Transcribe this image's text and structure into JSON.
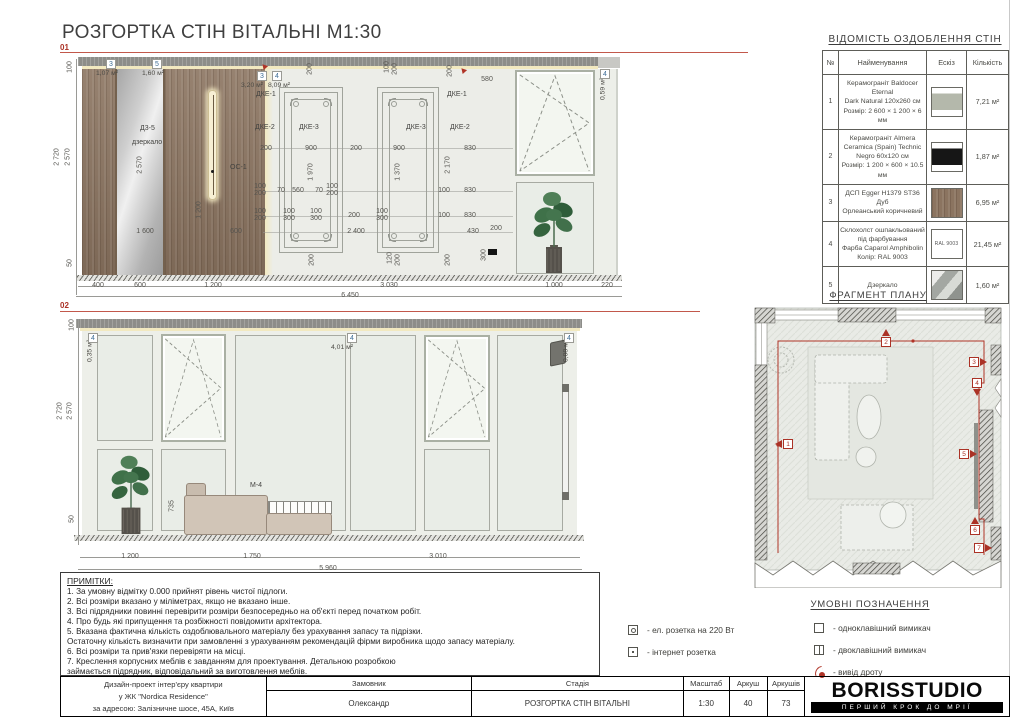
{
  "sheet": {
    "title": "РОЗГОРТКА СТІН ВІТАЛЬНІ М1:30"
  },
  "colors": {
    "accent_red": "#ab3226",
    "tag_blue": "#3e6d96",
    "wood": "#8b7460",
    "wall": "#ecede8"
  },
  "elevations": [
    {
      "label": "01",
      "dims": [
        [
          "100",
          10,
          22,
          1
        ],
        [
          "2 720",
          -3,
          112,
          1
        ],
        [
          "2 570",
          8,
          112,
          1
        ],
        [
          "50",
          10,
          218,
          1
        ],
        [
          "2 570",
          80,
          120,
          1
        ],
        [
          "1 200",
          139,
          165,
          1
        ],
        [
          "400",
          38,
          237
        ],
        [
          "600",
          80,
          237
        ],
        [
          "1 200",
          153,
          237
        ],
        [
          "3 030",
          329,
          237
        ],
        [
          "1 000",
          494,
          237
        ],
        [
          "220",
          547,
          237
        ],
        [
          "6 450",
          290,
          247
        ],
        [
          "1 600",
          85,
          183
        ],
        [
          "600",
          176,
          183
        ],
        [
          "2 400",
          296,
          183
        ],
        [
          "430",
          413,
          183
        ],
        [
          "200",
          436,
          180
        ],
        [
          "200",
          250,
          24,
          1
        ],
        [
          "100",
          327,
          22,
          1
        ],
        [
          "200",
          335,
          24,
          1
        ],
        [
          "200",
          390,
          26,
          1
        ],
        [
          "580",
          427,
          31
        ],
        [
          "200",
          206,
          100
        ],
        [
          "900",
          251,
          100
        ],
        [
          "200",
          296,
          100
        ],
        [
          "900",
          339,
          100
        ],
        [
          "830",
          410,
          100
        ],
        [
          "1 970",
          251,
          127,
          1
        ],
        [
          "1 370",
          338,
          127,
          1
        ],
        [
          "2 170",
          388,
          120,
          1
        ],
        [
          "100",
          200,
          138
        ],
        [
          "200",
          200,
          145
        ],
        [
          "70",
          221,
          142
        ],
        [
          "560",
          238,
          142
        ],
        [
          "70",
          259,
          142
        ],
        [
          "100",
          272,
          138
        ],
        [
          "200",
          272,
          145
        ],
        [
          "100",
          384,
          142
        ],
        [
          "830",
          410,
          142
        ],
        [
          "100",
          200,
          163
        ],
        [
          "200",
          200,
          170
        ],
        [
          "100",
          229,
          163
        ],
        [
          "300",
          229,
          170
        ],
        [
          "100",
          256,
          163
        ],
        [
          "300",
          256,
          170
        ],
        [
          "200",
          294,
          167
        ],
        [
          "100",
          322,
          163
        ],
        [
          "300",
          322,
          170
        ],
        [
          "100",
          384,
          167
        ],
        [
          "830",
          410,
          167
        ],
        [
          "200",
          252,
          215,
          1
        ],
        [
          "120",
          330,
          213,
          1
        ],
        [
          "200",
          338,
          215,
          1
        ],
        [
          "200",
          388,
          215,
          1
        ],
        [
          "300",
          424,
          210,
          1
        ]
      ],
      "tags": [
        [
          "3",
          "1,07 м²",
          46,
          14,
          36,
          25,
          0
        ],
        [
          "5",
          "1,60 м²",
          92,
          14,
          82,
          25,
          0
        ],
        [
          "3",
          "3,20 м²",
          197,
          26,
          181,
          37,
          0
        ],
        [
          "4",
          "8,09 м²",
          212,
          26,
          208,
          37,
          0
        ],
        [
          "4",
          "0,59 м²",
          540,
          24,
          543,
          44,
          1
        ]
      ],
      "labels": [
        [
          "Д3-5",
          80,
          80
        ],
        [
          "дзеркало",
          72,
          94
        ],
        [
          "ОС-1",
          170,
          119
        ],
        [
          "ДКЕ-1",
          196,
          46
        ],
        [
          "ДКЕ-1",
          387,
          46
        ],
        [
          "ДКЕ-2",
          195,
          79
        ],
        [
          "ДКЕ-3",
          239,
          79
        ],
        [
          "ДКЕ-3",
          346,
          79
        ],
        [
          "ДКЕ-2",
          390,
          79
        ]
      ]
    },
    {
      "label": "02",
      "dims": [
        [
          "100",
          12,
          22,
          1
        ],
        [
          "2 720",
          0,
          108,
          1
        ],
        [
          "2 570",
          10,
          108,
          1
        ],
        [
          "50",
          12,
          216,
          1
        ],
        [
          "1 200",
          70,
          250
        ],
        [
          "1 750",
          192,
          250
        ],
        [
          "3 010",
          378,
          250
        ],
        [
          "5 960",
          268,
          262
        ],
        [
          "735",
          112,
          203,
          1
        ]
      ],
      "tags": [
        [
          "4",
          "0,35 м²",
          28,
          30,
          30,
          48,
          1
        ],
        [
          "4",
          "4,01 м²",
          287,
          30,
          271,
          41,
          0
        ],
        [
          "4",
          "0,08 м²",
          504,
          30,
          506,
          48,
          1
        ]
      ],
      "labels": [
        [
          "М-4",
          190,
          179
        ]
      ]
    }
  ],
  "finish_table": {
    "title": "ВІДОМІСТЬ ОЗДОБЛЕННЯ СТІН",
    "headers": [
      "№",
      "Найменування",
      "Ескіз",
      "Кількість"
    ],
    "rows": [
      {
        "no": "1",
        "name": [
          "Керамограніт Baldocer Eternal",
          "Dark Natural 120x260 см",
          "Розмір: 2 600 × 1 200 × 6 мм"
        ],
        "swatch": "tile-gray",
        "qty": "7,21 м²"
      },
      {
        "no": "2",
        "name": [
          "Керамограніт Almera",
          "Ceramica (Spain) Technic",
          "Negro 60x120 см",
          "Розмір: 1 200 × 600 × 10.5 мм"
        ],
        "swatch": "tile-black",
        "qty": "1,87 м²"
      },
      {
        "no": "3",
        "name": [
          "ДСП Egger H1379 ST36 Дуб",
          "Орлеанський коричневий"
        ],
        "swatch": "wood",
        "qty": "6,95 м²"
      },
      {
        "no": "4",
        "name": [
          "Склохолст ошпакльований",
          "під фарбування",
          "Фарба Caparol Amphibolin",
          "Колір: RAL 9003"
        ],
        "swatch": "ral",
        "swatch_text": "RAL 9003",
        "qty": "21,45 м²"
      },
      {
        "no": "5",
        "name": [
          "Дзеркало"
        ],
        "swatch": "mirror",
        "qty": "1,60 м²"
      }
    ]
  },
  "plan": {
    "title": "ФРАГМЕНТ ПЛАНУ",
    "markers": [
      [
        1,
        30,
        134,
        "left"
      ],
      [
        2,
        128,
        32,
        "up"
      ],
      [
        3,
        216,
        52,
        "right"
      ],
      [
        4,
        219,
        73,
        "down"
      ],
      [
        5,
        206,
        144,
        "right"
      ],
      [
        6,
        217,
        220,
        "up"
      ],
      [
        7,
        221,
        238,
        "right"
      ]
    ]
  },
  "legend": {
    "title": "УМОВНІ ПОЗНАЧЕННЯ",
    "items": [
      {
        "icon": "socket220",
        "label": "- ел. розетка на 220 Вт",
        "col": 1
      },
      {
        "icon": "internet",
        "label": "- інтернет розетка",
        "col": 1
      },
      {
        "icon": "switch1",
        "label": "- одноклавішний вимикач",
        "col": 2
      },
      {
        "icon": "switch2",
        "label": "- двоклавішний вимикач",
        "col": 2
      },
      {
        "icon": "wire",
        "label": "- вивід дроту",
        "col": 2
      }
    ]
  },
  "notes": {
    "title": "ПРИМІТКИ:",
    "lines": [
      "1. За умовну відмітку 0.000 прийнят рівень чистої підлоги.",
      "2. Всі розміри вказано у міліметрах, якщо не вказано інше.",
      "3. Всі підрядники повинні перевірити розміри безпосередньо на об'єкті перед початком робіт.",
      "4. Про будь які припущення та розбіжності повідомити архітектора.",
      "5. Вказана фактична кількість оздоблювального матеріалу без урахування запасу та підрізки.",
      "Остаточну кількість визначити при замовленні з урахуванням рекомендацій фірми виробника щодо запасу матеріалу.",
      "6. Всі розміри та прив'язки перевіряти на місці.",
      "7. Креслення корпусних меблів є завданням для проектування. Детальною розробкою",
      "займається підрядник, відповідальний за виготовлення меблів."
    ]
  },
  "titleblock": {
    "project_lines": [
      "Дизайн-проект інтер'єру квартири",
      "у ЖК \"Nordica Residence\"",
      "за адресою: Залізничне шосе, 45А, Київ"
    ],
    "cols": [
      {
        "header": "Замовник",
        "value": "Олександр"
      },
      {
        "header": "Стадія",
        "value": "РОЗГОРТКА СТІН ВІТАЛЬНІ"
      },
      {
        "header": "Масштаб",
        "value": "1:30"
      },
      {
        "header": "Аркуш",
        "value": "40"
      },
      {
        "header": "Аркушів",
        "value": "73"
      }
    ],
    "logo": {
      "name": "BORISSTUDIO",
      "tagline": "ПЕРШИЙ КРОК ДО МРІЇ"
    }
  }
}
